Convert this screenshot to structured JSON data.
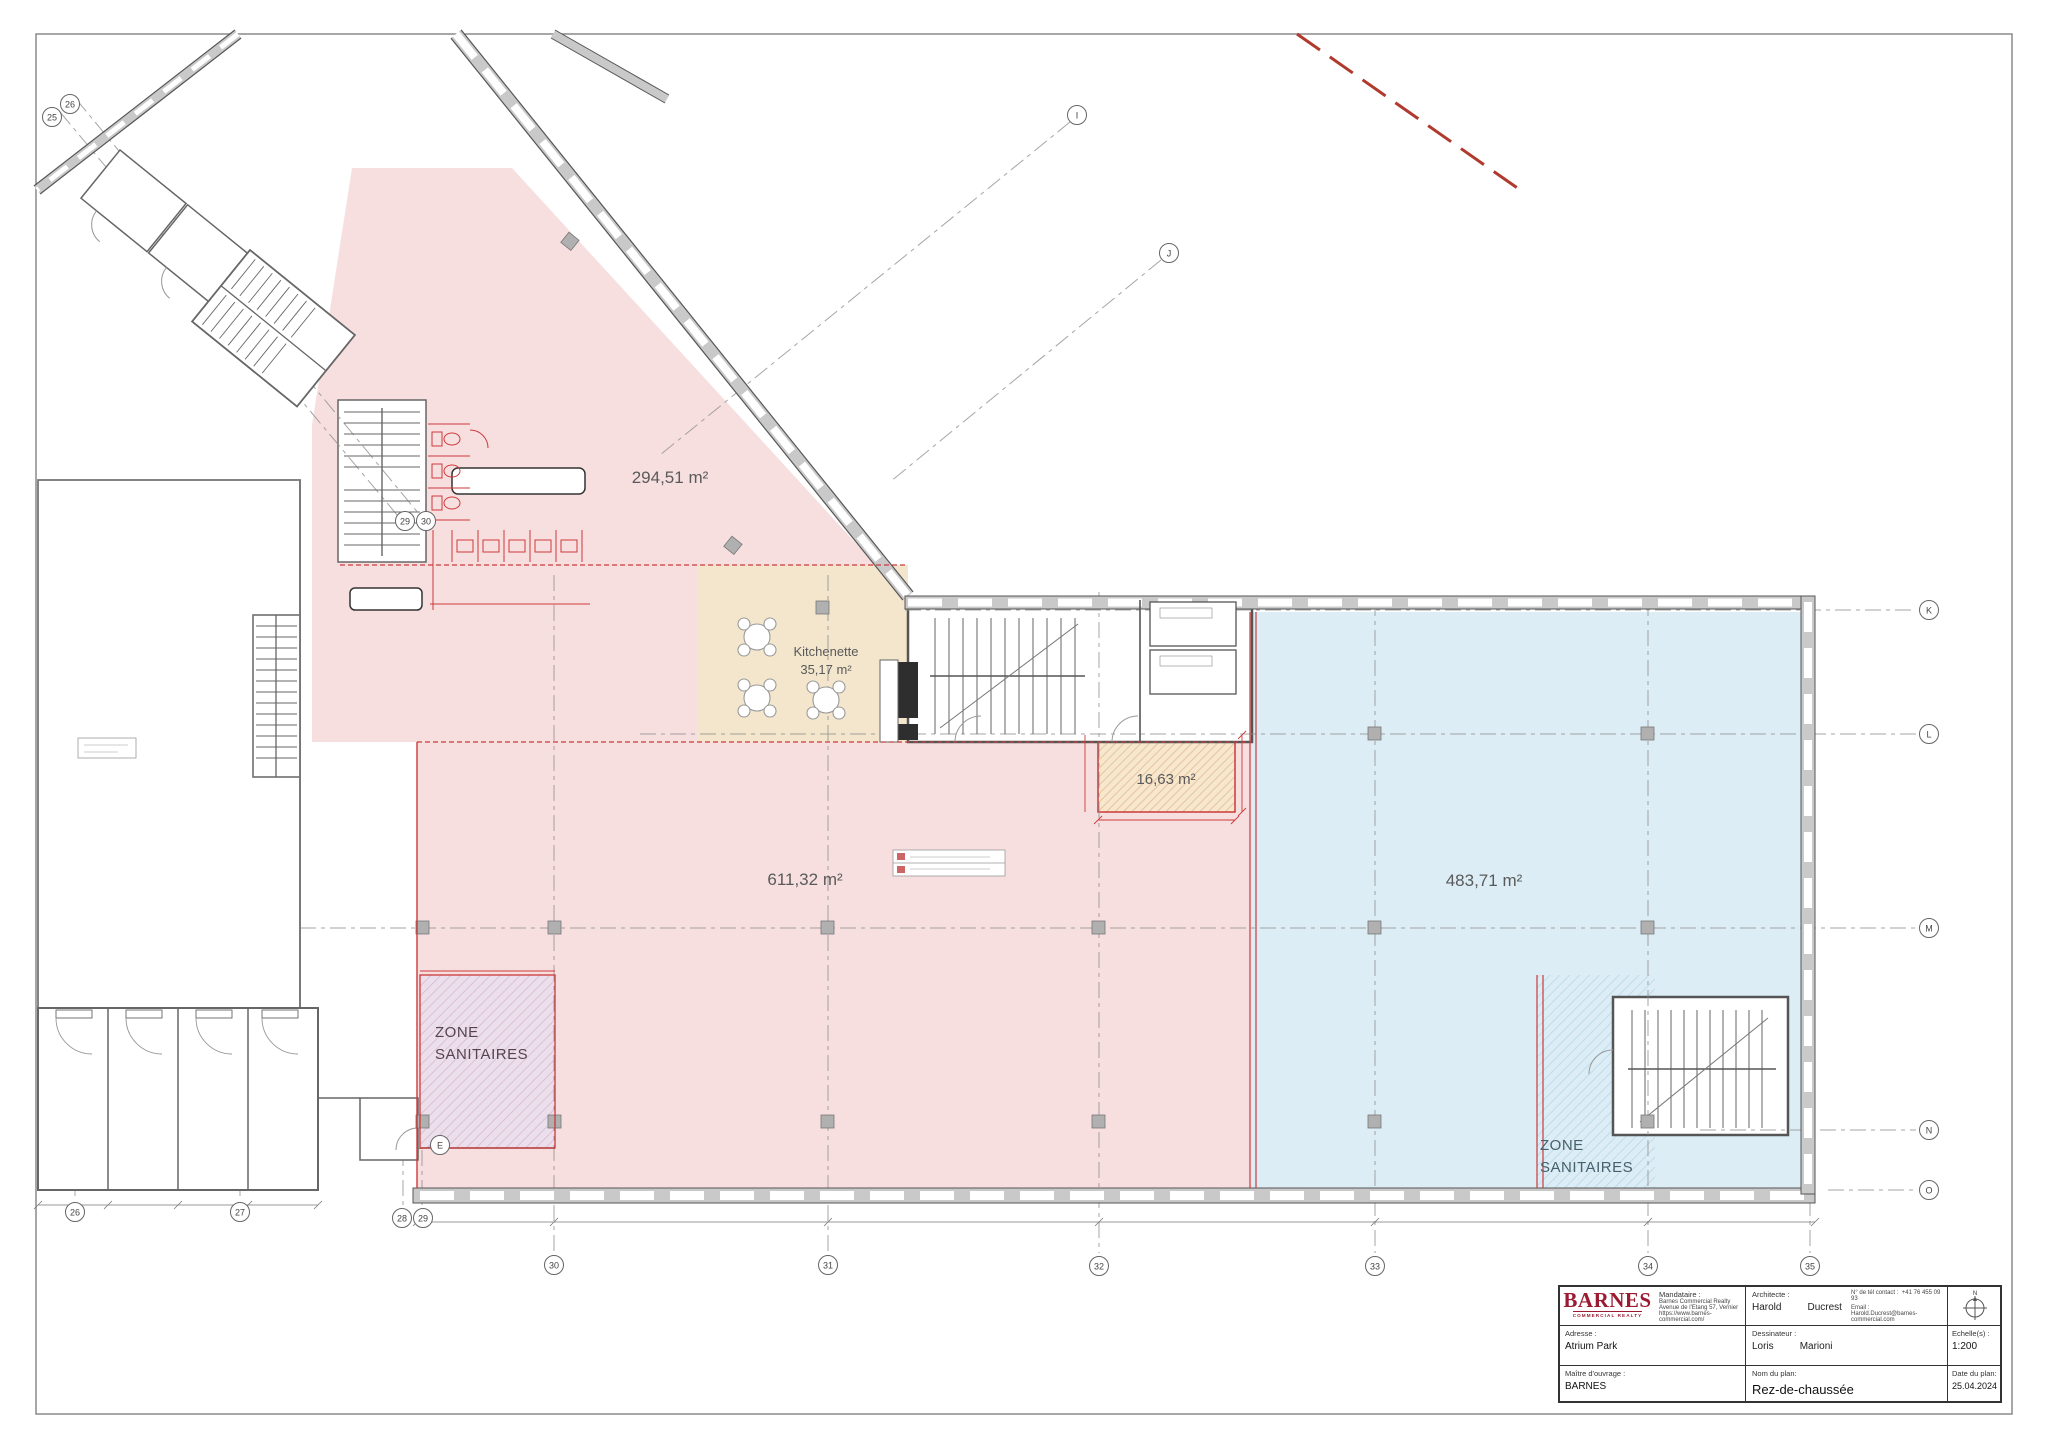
{
  "plan": {
    "labels": {
      "area_top": "294,51 m²",
      "kitchenette_line1": "Kitchenette",
      "kitchenette_line2": "35,17 m²",
      "area_main": "611,32 m²",
      "area_small": "16,63 m²",
      "area_right": "483,71 m²",
      "zone_left_line1": "ZONE",
      "zone_left_line2": "SANITAIRES",
      "zone_right_line1": "ZONE",
      "zone_right_line2": "SANITAIRES"
    },
    "grid_labels": {
      "tl_25": "25",
      "tl_26": "26",
      "i": "I",
      "j": "J",
      "k": "K",
      "l": "L",
      "m": "M",
      "n": "N",
      "o": "O",
      "bl_26": "26",
      "bl_27": "27",
      "bl_28": "28",
      "bl_29": "29",
      "e": "E",
      "mid_29": "29",
      "mid_30": "30",
      "b_30": "30",
      "b_31": "31",
      "b_32": "32",
      "b_33": "33",
      "b_34": "34",
      "b_35": "35"
    },
    "colors": {
      "zone_pink": "#f7dfe0",
      "zone_tan": "#f3e6cd",
      "zone_blue": "#dcedf6",
      "zone_purple": "#ecdfec",
      "accent_red": "#cc3a3a",
      "boundary_dashed_red": "#b03a2e",
      "wall_gray": "#555555"
    }
  },
  "title_block": {
    "logo": {
      "name": "BARNES",
      "subtitle": "COMMERCIAL REALTY"
    },
    "mandataire": {
      "label": "Mandataire :",
      "line1": "Barnes Commercial Realty",
      "line2": "Avenue de l'Etang 57, Vernier",
      "line3": "https://www.barnes-commercial.com/"
    },
    "architecte": {
      "label": "Architecte :",
      "first": "Harold",
      "last": "Ducrest"
    },
    "contact": {
      "phone_label": "N° de tél contact :",
      "phone": "+41 76 455 09 93",
      "email_label": "Email :",
      "email": "Harold.Ducrest@barnes-commercial.com"
    },
    "adresse": {
      "label": "Adresse :",
      "value": "Atrium Park"
    },
    "dessinateur": {
      "label": "Dessinateur :",
      "first": "Loris",
      "last": "Marioni"
    },
    "echelle": {
      "label": "Echelle(s) :",
      "value": "1:200"
    },
    "maitre": {
      "label": "Maître d'ouvrage :",
      "value": "BARNES"
    },
    "plan_name": {
      "label": "Nom du plan:",
      "value": "Rez-de-chaussée"
    },
    "date": {
      "label": "Date du plan:",
      "value": "25.04.2024"
    },
    "north": "N"
  }
}
